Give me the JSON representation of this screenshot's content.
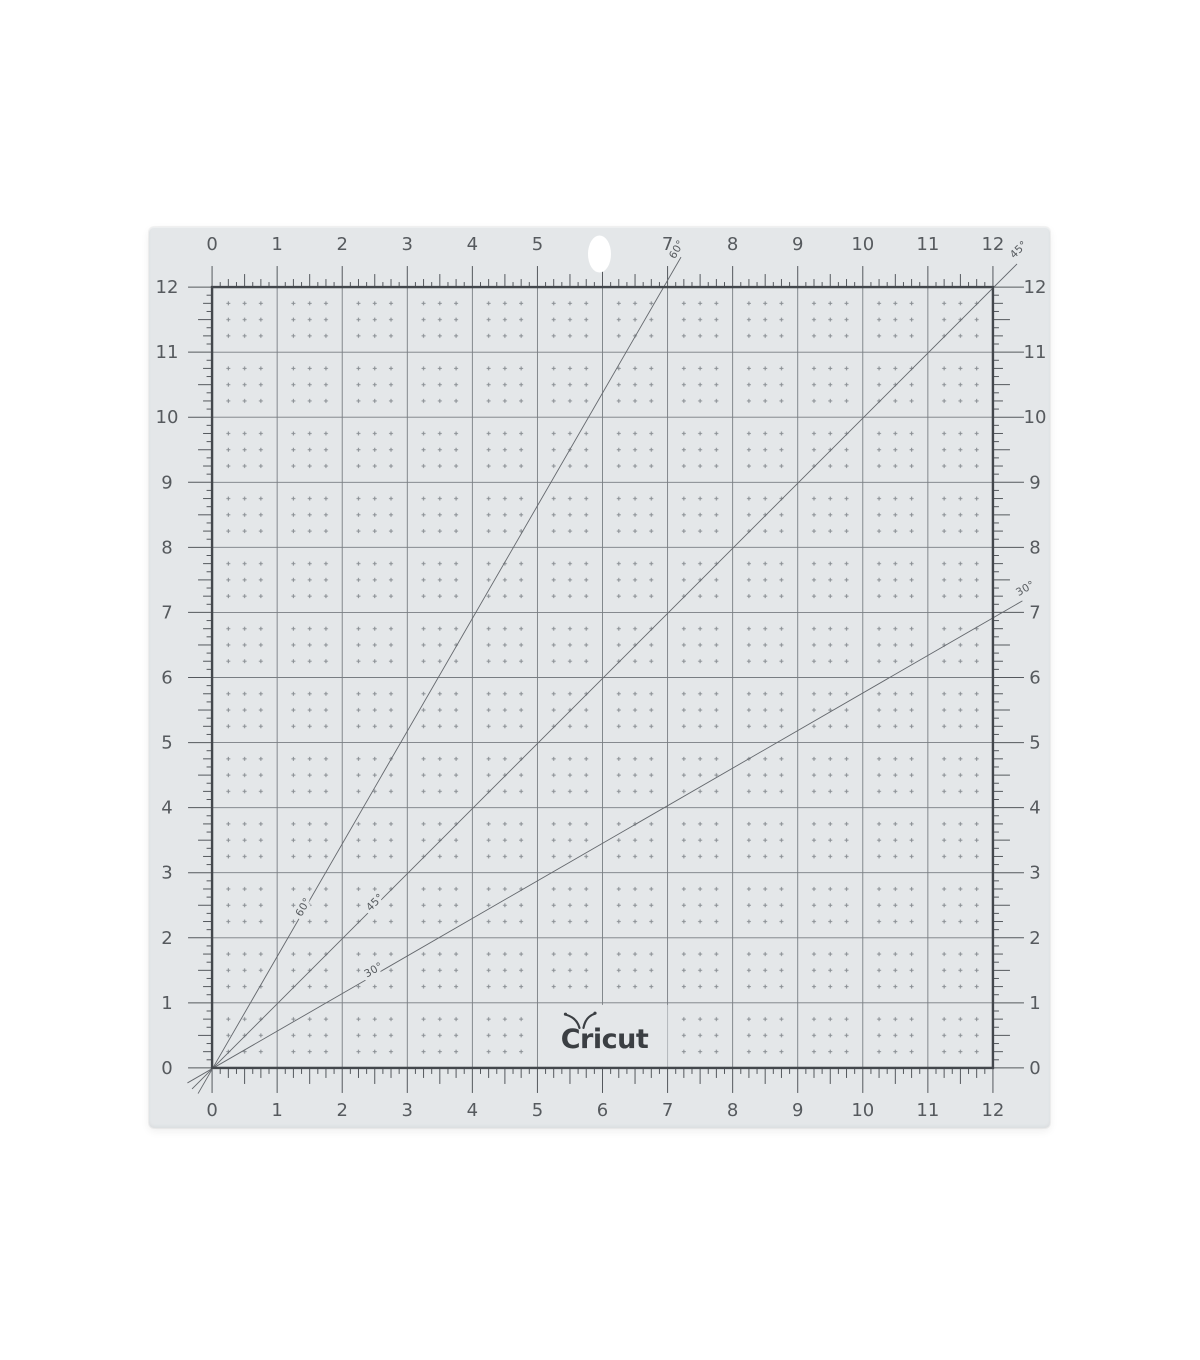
{
  "page": {
    "background_color": "#ffffff"
  },
  "mat": {
    "description": "12 x 12 inch self-healing craft cutting mat with 1-inch grid",
    "color": "#e4e7e9",
    "grid_line_color": "#787d82",
    "border_color": "#43474c",
    "tick_color": "#54585d",
    "number_color": "#565a5e",
    "dot_color": "#8a8f94",
    "diagonal_color": "#64686d",
    "logo_color": "#3b3f43",
    "grid_inches": 12,
    "subdivisions_per_inch": 8
  },
  "ruler": {
    "top": [
      "0",
      "1",
      "2",
      "3",
      "4",
      "5",
      "",
      "7",
      "8",
      "9",
      "10",
      "11",
      "12"
    ],
    "bottom": [
      "0",
      "1",
      "2",
      "3",
      "4",
      "5",
      "6",
      "7",
      "8",
      "9",
      "10",
      "11",
      "12"
    ],
    "left": [
      "12",
      "11",
      "10",
      "9",
      "8",
      "7",
      "6",
      "5",
      "4",
      "3",
      "2",
      "1",
      "0"
    ],
    "right": [
      "12",
      "11",
      "10",
      "9",
      "8",
      "7",
      "6",
      "5",
      "4",
      "3",
      "2",
      "1",
      "0"
    ]
  },
  "angles": [
    {
      "deg": 30,
      "label": "30°"
    },
    {
      "deg": 45,
      "label": "45°"
    },
    {
      "deg": 60,
      "label": "60°"
    }
  ],
  "logo": {
    "text": "Cricut"
  }
}
